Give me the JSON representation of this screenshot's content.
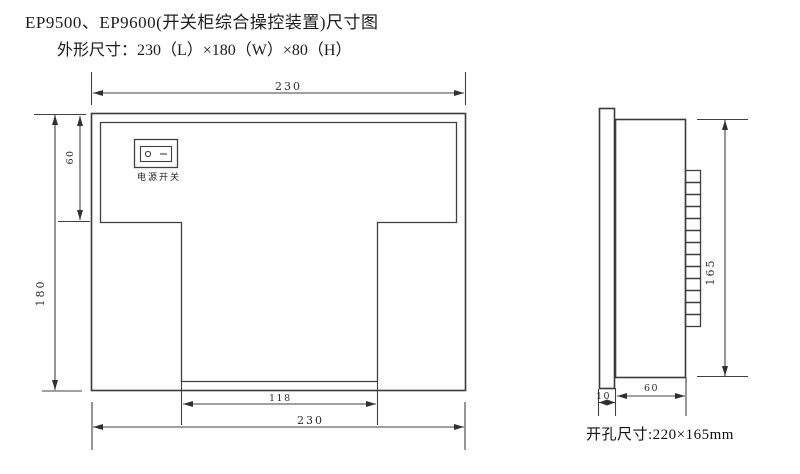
{
  "page": {
    "title": "EP9500、EP9600(开关柜综合操控装置)尺寸图",
    "subtitle": "外形尺寸：230（L）×180（W）×80（H）",
    "cutout_note": "开孔尺寸:220×165mm"
  },
  "front_view": {
    "dim_width_top": "230",
    "dim_height_left": "180",
    "dim_top_section_height": "60",
    "dim_cutout_width": "118",
    "dim_width_bottom": "230",
    "power_switch_label": "电源开关"
  },
  "side_view": {
    "dim_panel_height": "165",
    "dim_body_depth": "60",
    "dim_flange_depth": "10"
  }
}
